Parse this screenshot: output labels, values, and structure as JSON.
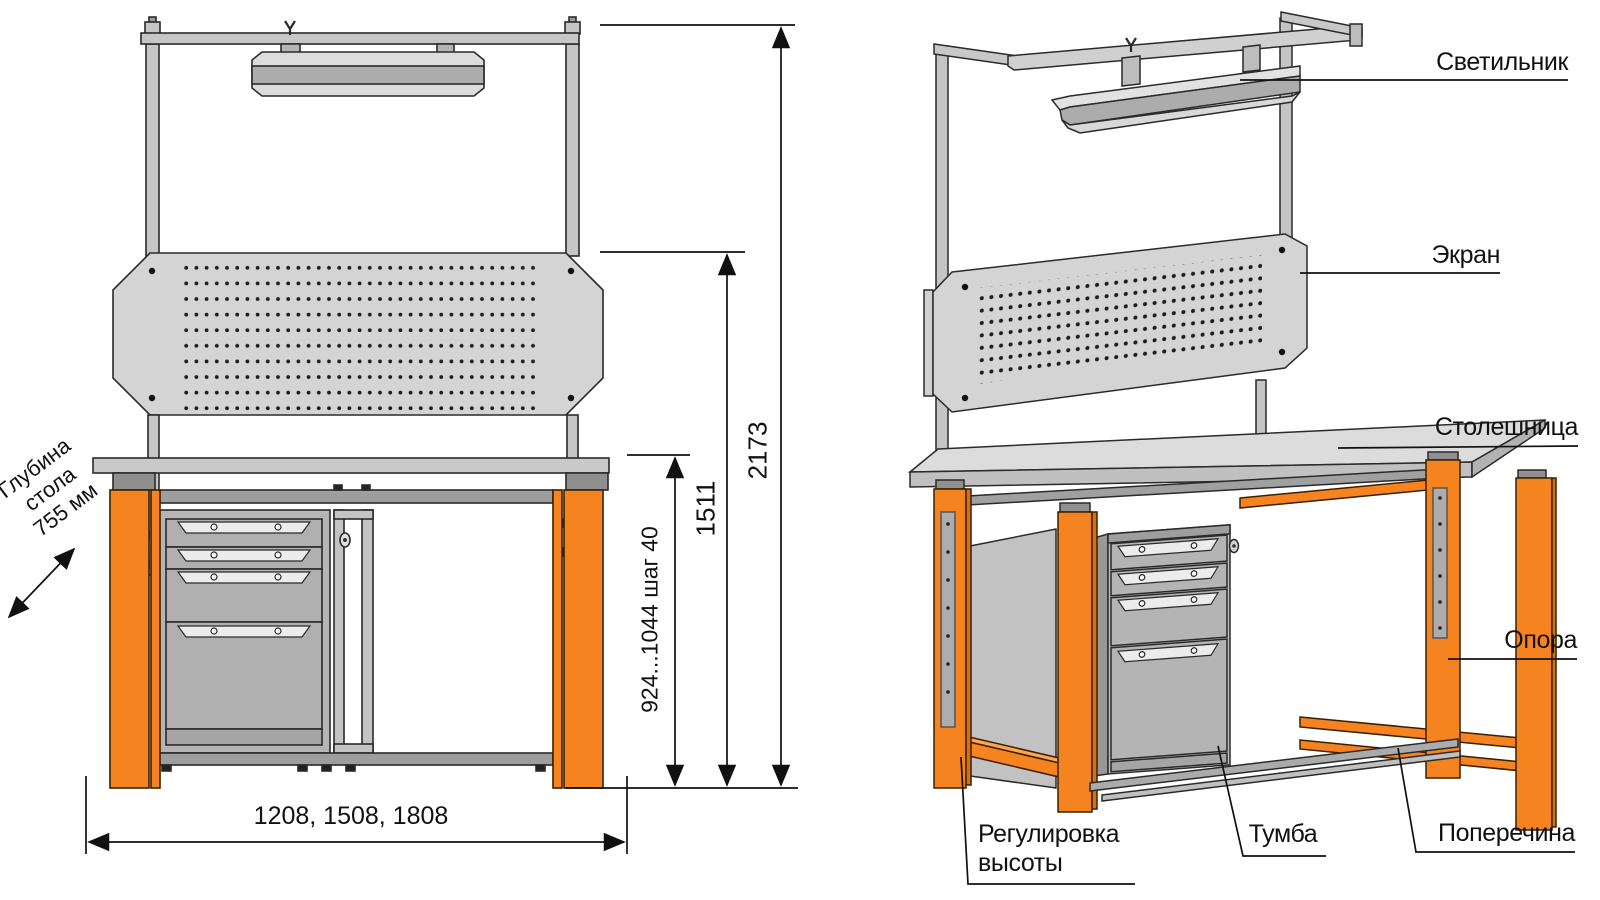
{
  "drawing": {
    "type": "workbench-assembly-diagram",
    "views": [
      "front-orthographic",
      "isometric"
    ]
  },
  "dimensions": {
    "height_total": "2173",
    "height_screen": "1511",
    "height_table": "924...1044 шаг 40",
    "width_options": "1208, 1508, 1808",
    "depth": "Глубина стола 755 мм"
  },
  "callouts": {
    "lamp": "Светильник",
    "screen": "Экран",
    "tabletop": "Столешница",
    "support": "Опора",
    "height_adjust": "Регулировка высоты",
    "cabinet": "Тумба",
    "crossbar": "Поперечина"
  },
  "colors": {
    "accent_orange": "#F5831F",
    "panel_gray": "#D2D2D2",
    "mid_gray": "#ACACAC",
    "dark_gray": "#8F8F8F",
    "line": "#2a2a2a"
  }
}
